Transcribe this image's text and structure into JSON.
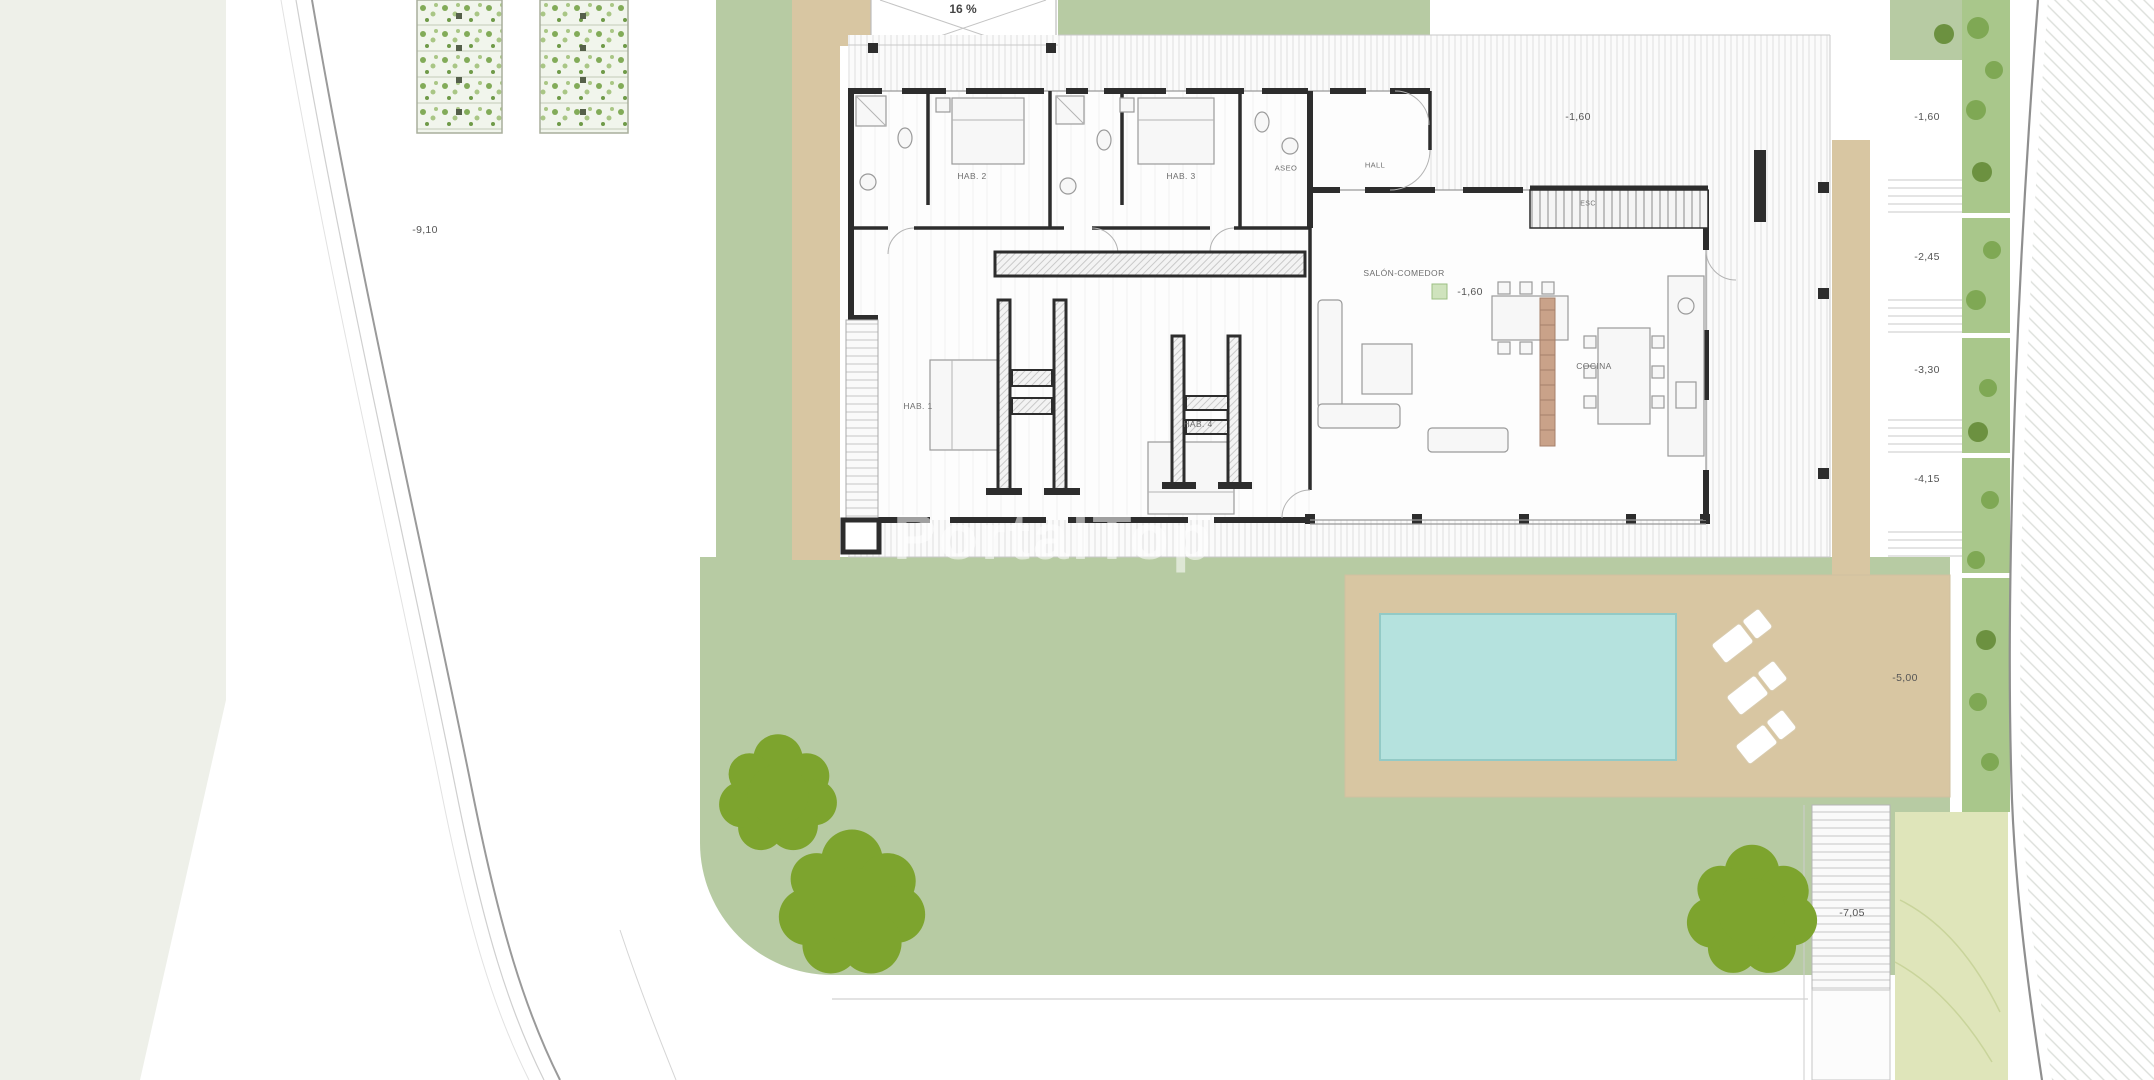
{
  "watermark": "PortalTop",
  "labels": {
    "slope": "16 %",
    "elev_left": "-9,10",
    "elev_top": "-1,60",
    "elev_salon": "-1,60",
    "elev_r1": "-1,60",
    "elev_r2": "-2,45",
    "elev_r3": "-3,30",
    "elev_r4": "-4,15",
    "elev_pool": "-5,00",
    "elev_lower": "-7,05"
  },
  "rooms": {
    "hab1": "HAB. 1",
    "hab2": "HAB. 2",
    "hab3": "HAB. 3",
    "hab4": "HAB. 4",
    "aseo": "ASEO",
    "hall": "HALL",
    "salon": "SALÓN-COMEDOR",
    "cocina": "COCINA",
    "esc": "ESC"
  },
  "colors": {
    "lawn": "#b7cba3",
    "tree": "#7da42e",
    "beige": "#d8c6a2",
    "pool": "#b5e2de",
    "poolEdge": "#93cac6",
    "pale": "#eef0e9",
    "strip": "#a9c78b",
    "bush": "#7fa854",
    "slope": "#dfe5ba",
    "wall": "#2d2d2d"
  }
}
